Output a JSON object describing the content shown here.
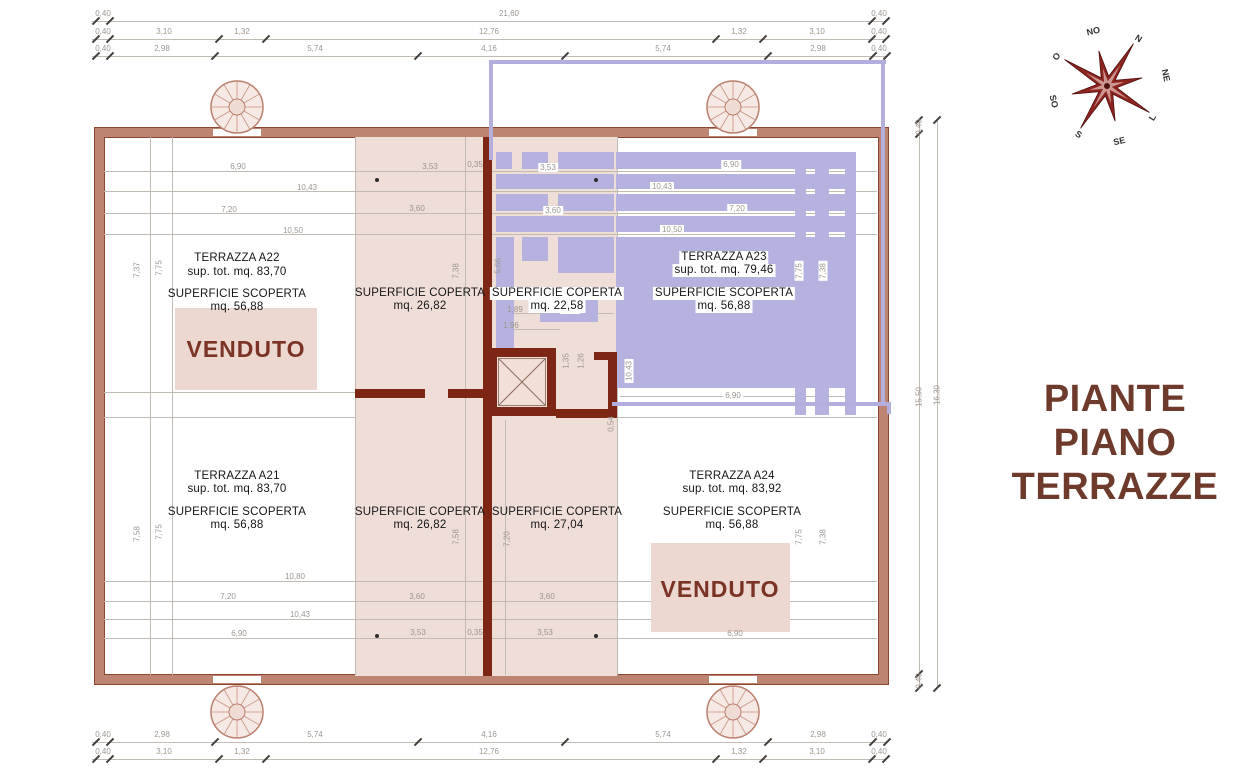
{
  "document": {
    "title_lines": [
      "PIANTE",
      "PIANO",
      "TERRAZZE"
    ]
  },
  "compass": {
    "n": "N",
    "ne": "NE",
    "e": "L",
    "se": "SE",
    "s": "S",
    "so": "SO",
    "o": "O",
    "no": "NO"
  },
  "units": {
    "a22": {
      "name": "TERRAZZA A22",
      "total": "sup. tot. mq. 83,70",
      "open_label": "SUPERFICIE SCOPERTA",
      "open_value": "mq. 56,88",
      "status": "VENDUTO"
    },
    "a23": {
      "name": "TERRAZZA A23",
      "total": "sup. tot. mq. 79,46",
      "open_label": "SUPERFICIE SCOPERTA",
      "open_value": "mq. 56,88"
    },
    "a21": {
      "name": "TERRAZZA A21",
      "total": "sup. tot. mq. 83,70",
      "open_label": "SUPERFICIE SCOPERTA",
      "open_value": "mq. 56,88"
    },
    "a24": {
      "name": "TERRAZZA A24",
      "total": "sup. tot. mq. 83,92",
      "open_label": "SUPERFICIE SCOPERTA",
      "open_value": "mq. 56,88",
      "status": "VENDUTO"
    },
    "coperta_top_left": {
      "label": "SUPERFICIE COPERTA",
      "value": "mq. 26,82"
    },
    "coperta_top_right": {
      "label": "SUPERFICIE COPERTA",
      "value": "mq. 22,58"
    },
    "coperta_bottom_left": {
      "label": "SUPERFICIE COPERTA",
      "value": "mq. 26,82"
    },
    "coperta_bottom_right": {
      "label": "SUPERFICIE COPERTA",
      "value": "mq. 27,04"
    }
  },
  "dims": {
    "top_row1": [
      "0,40",
      "21,60",
      "0,40"
    ],
    "top_row2": [
      "0,40",
      "3,10",
      "1,32",
      "12,76",
      "1,32",
      "3,10",
      "0,40"
    ],
    "top_row3": [
      "0,40",
      "2,98",
      "5,74",
      "4,16",
      "5,74",
      "2,98",
      "0,40"
    ],
    "bottom_row1": [
      "0,40",
      "2,98",
      "5,74",
      "4,16",
      "5,74",
      "2,98",
      "0,40"
    ],
    "bottom_row2": [
      "0,40",
      "3,10",
      "1,32",
      "12,76",
      "1,32",
      "3,10",
      "0,40"
    ],
    "right_col": {
      "top": "0,40",
      "mid": "15,50",
      "bottom": "0,40",
      "overall": "16,30"
    },
    "quad_top_left": [
      "6,90",
      "10,43",
      "7,20",
      "10,50"
    ],
    "quad_top_right": [
      "6,90",
      "10,43",
      "7,20",
      "10,50"
    ],
    "quad_bottom_left": [
      "10,80",
      "7,20",
      "10,43",
      "6,90"
    ],
    "quad_bottom_right": [
      "6,90"
    ],
    "mid_top": {
      "a": "3,53",
      "b": "0,35",
      "c": "3,53",
      "d": "3,60",
      "e": "3,60"
    },
    "mid_bottom": {
      "a": "3,60",
      "b": "3,60",
      "c": "3,53",
      "d": "0,35",
      "e": "3,53"
    },
    "vert": {
      "tl_a": "7,37",
      "tl_b": "7,75",
      "bl_a": "7,58",
      "bl_b": "7,75",
      "mt_a": "7,38",
      "mt_b": "5,66",
      "mb_a": "7,58",
      "mb_b": "7,20",
      "tr_a": "7,75",
      "tr_b": "7,38",
      "br_a": "7,75",
      "br_b": "7,38"
    },
    "core": {
      "a": "1,89",
      "b": "1,54",
      "c": "1,96",
      "d": "1,35",
      "e": "1,26",
      "f": "10,43",
      "g": "0,54",
      "h": "6,90"
    }
  },
  "colors": {
    "highlight_purple": "#b5b2df",
    "wall_brown": "#bc8471",
    "wall_red": "#7e2614",
    "covered_pink": "#efddd7",
    "venduto_fill": "#ecd8d1",
    "title_maroon": "#6e3a2b"
  }
}
